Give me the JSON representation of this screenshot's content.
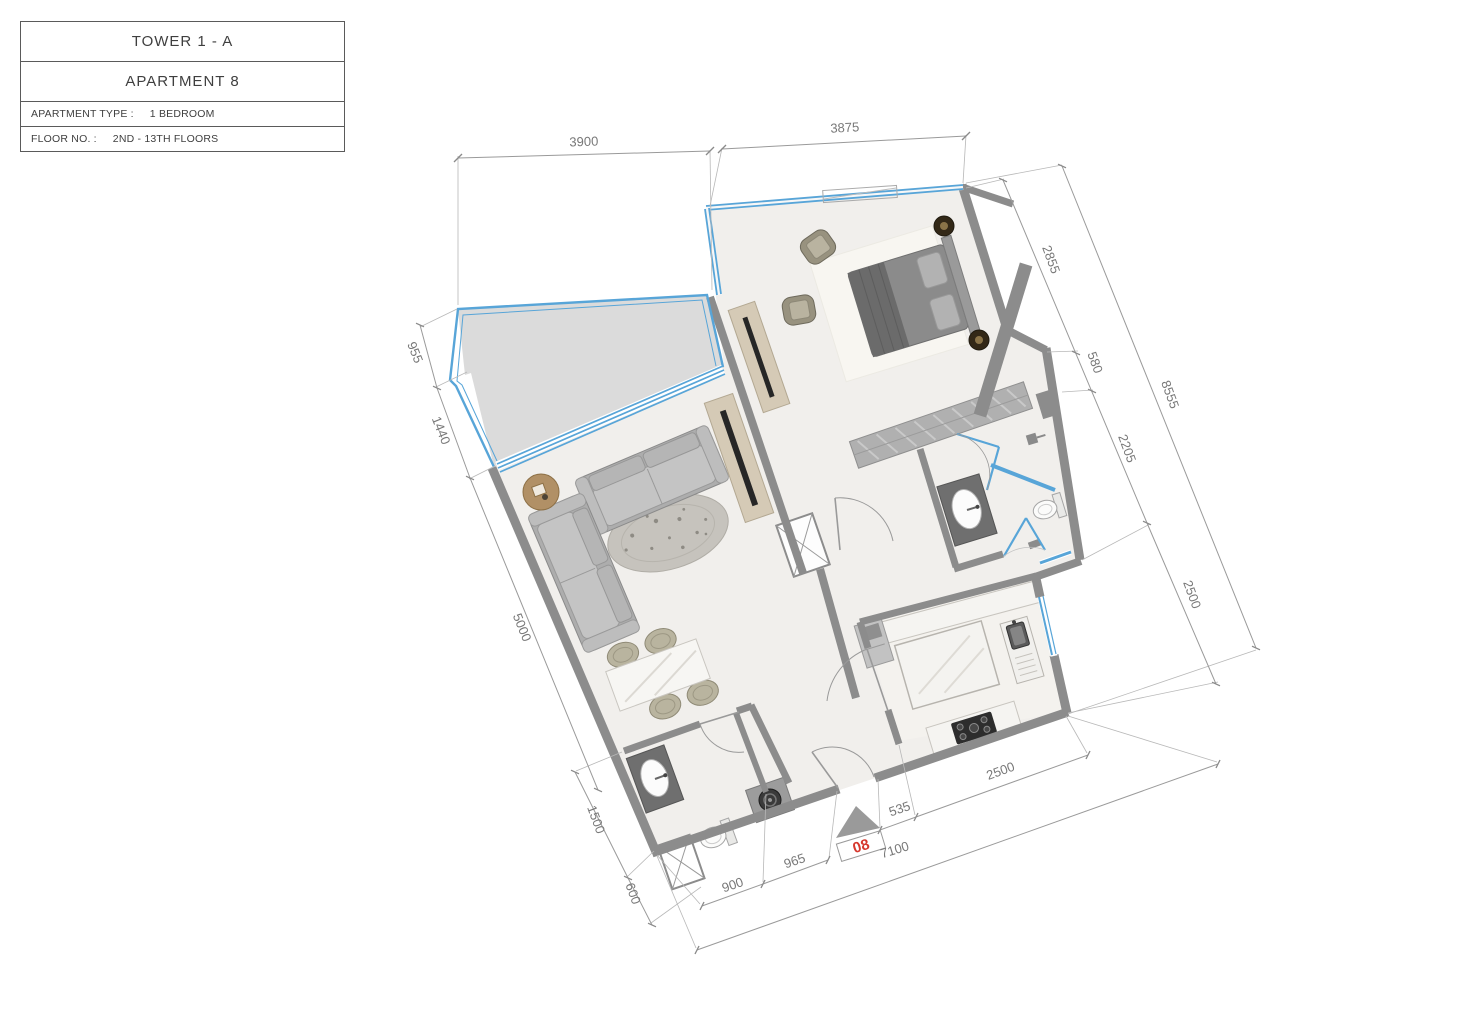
{
  "title_block": {
    "tower": "TOWER 1 - A",
    "apartment": "APARTMENT  8",
    "type_label": "APARTMENT TYPE :",
    "type_value": "1  BEDROOM",
    "floor_label": "FLOOR NO. :",
    "floor_value": "2ND - 13TH FLOORS"
  },
  "unit": {
    "number": "08"
  },
  "dims": {
    "top_balcony": "3900",
    "top_bedroom": "3875",
    "right_bedroom": "2855",
    "right_wardrobe": "580",
    "right_bath": "2205",
    "right_kitchen": "2500",
    "right_overall": "8555",
    "left_balcony_upper": "955",
    "left_balcony_lower": "1440",
    "left_living": "5000",
    "left_bath": "1500",
    "left_shaft": "600",
    "bottom_bath": "900",
    "bottom_hall": "965",
    "bottom_entry": "535",
    "bottom_kitchen": "2500",
    "bottom_overall": "7100"
  },
  "colors": {
    "window_blue": "#58a5d8",
    "wall_gray": "#8c8c8c",
    "unit_red": "#d6382e",
    "balcony_gray": "#dbdbdb"
  }
}
